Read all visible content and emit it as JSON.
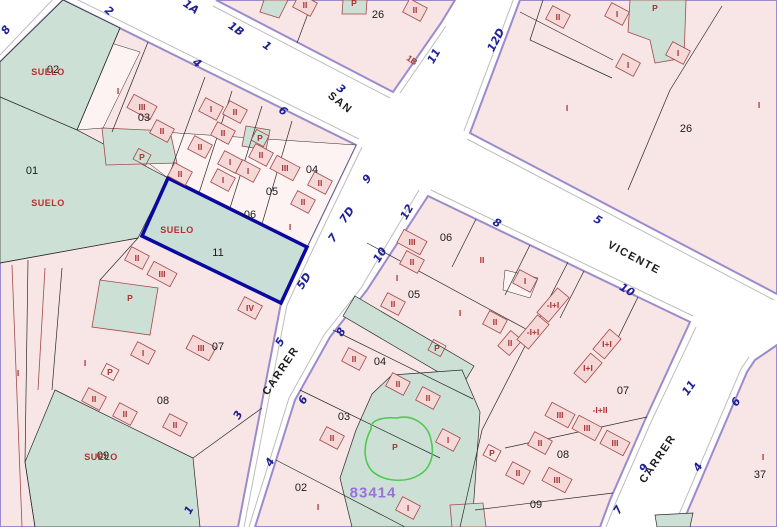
{
  "map": {
    "type": "cadastral parcel map",
    "selected_parcel": "11",
    "reference": "83414",
    "colors": {
      "block_fill": "#f8e5e5",
      "light_parcel_fill": "#fdf3f3",
      "green_fill": "#cde0d5",
      "block_border": "#9a8ccc",
      "parcel_line": "#2a2a2a",
      "building_line": "#a34a4a",
      "building_fill": "#f5d8d8",
      "street_number_color": "#1f1f96",
      "street_name_color": "#1c1c1c",
      "label_red": "#ab3232",
      "suelo_red": "#b53030",
      "selected_border": "#0909a0",
      "reference_purple": "#9a70dc",
      "highlight_green": "#4fc94f",
      "street_casing": "#bdbdbd"
    },
    "labels": {
      "street_names": [
        [
          "SAN",
          340,
          103,
          38
        ],
        [
          "VICENTE",
          634,
          258,
          28
        ],
        [
          "CARRER",
          281,
          371,
          -56
        ],
        [
          "CARRER",
          658,
          459,
          -56
        ]
      ],
      "street_numbers": [
        [
          "8",
          6,
          30,
          -55
        ],
        [
          "2",
          109,
          11,
          40
        ],
        [
          "1A",
          191,
          7,
          35
        ],
        [
          "1B",
          236,
          29,
          35
        ],
        [
          "1",
          267,
          46,
          35
        ],
        [
          "4",
          197,
          63,
          38
        ],
        [
          "3",
          341,
          89,
          38
        ],
        [
          "6",
          283,
          111,
          38
        ],
        [
          "11",
          434,
          56,
          -60
        ],
        [
          "12D",
          496,
          40,
          -62
        ],
        [
          "9",
          367,
          179,
          -50
        ],
        [
          "7D",
          347,
          215,
          -55
        ],
        [
          "7",
          333,
          238,
          -55
        ],
        [
          "5D",
          304,
          281,
          -58
        ],
        [
          "5",
          280,
          342,
          -58
        ],
        [
          "3",
          238,
          415,
          -60
        ],
        [
          "1",
          189,
          510,
          -62
        ],
        [
          "12",
          407,
          212,
          -60
        ],
        [
          "10",
          380,
          255,
          -58
        ],
        [
          "8",
          341,
          332,
          -58
        ],
        [
          "6",
          303,
          400,
          -58
        ],
        [
          "4",
          270,
          462,
          -60
        ],
        [
          "8",
          497,
          223,
          30
        ],
        [
          "5",
          598,
          220,
          30
        ],
        [
          "10",
          627,
          290,
          30
        ],
        [
          "11",
          689,
          388,
          -55
        ],
        [
          "9",
          644,
          468,
          -58
        ],
        [
          "7",
          618,
          510,
          -58
        ],
        [
          "6",
          736,
          402,
          -55
        ],
        [
          "4",
          698,
          467,
          -58
        ]
      ],
      "parcel_numbers": [
        [
          "02",
          53,
          70
        ],
        [
          "01",
          32,
          171
        ],
        [
          "03",
          144,
          118
        ],
        [
          "04",
          312,
          170
        ],
        [
          "05",
          272,
          192
        ],
        [
          "06",
          250,
          215
        ],
        [
          "11",
          218,
          253
        ],
        [
          "07",
          218,
          347
        ],
        [
          "08",
          163,
          401
        ],
        [
          "09",
          103,
          456
        ],
        [
          "26",
          378,
          15
        ],
        [
          "26",
          686,
          129
        ],
        [
          "06",
          446,
          238
        ],
        [
          "05",
          414,
          295
        ],
        [
          "04",
          380,
          362
        ],
        [
          "03",
          344,
          417
        ],
        [
          "02",
          301,
          488
        ],
        [
          "07",
          623,
          391
        ],
        [
          "08",
          563,
          455
        ],
        [
          "09",
          536,
          505
        ],
        [
          "37",
          760,
          475
        ]
      ],
      "suelo_labels": [
        [
          "SUELO",
          48,
          72
        ],
        [
          "SUELO",
          48,
          203
        ],
        [
          "SUELO",
          177,
          230
        ],
        [
          "SUELO",
          101,
          457
        ]
      ],
      "building_labels": [
        [
          "I",
          118,
          91,
          28,
          1
        ],
        [
          "III",
          142,
          107
        ],
        [
          "II",
          162,
          131
        ],
        [
          "P",
          142,
          157
        ],
        [
          "II",
          200,
          147
        ],
        [
          "II",
          180,
          174
        ],
        [
          "I",
          211,
          109
        ],
        [
          "II",
          235,
          112
        ],
        [
          "II",
          223,
          133
        ],
        [
          "P",
          260,
          138
        ],
        [
          "II",
          261,
          155
        ],
        [
          "I",
          230,
          162
        ],
        [
          "I",
          248,
          171
        ],
        [
          "I",
          223,
          180
        ],
        [
          "III",
          285,
          168
        ],
        [
          "II",
          320,
          183
        ],
        [
          "II",
          303,
          202
        ],
        [
          "I",
          290,
          227,
          28,
          1
        ],
        [
          "II",
          137,
          258
        ],
        [
          "III",
          162,
          274
        ],
        [
          "P",
          130,
          298,
          28,
          1
        ],
        [
          "IV",
          250,
          308
        ],
        [
          "I",
          85,
          363,
          28,
          1
        ],
        [
          "I",
          143,
          353
        ],
        [
          "P",
          110,
          372
        ],
        [
          "III",
          201,
          348
        ],
        [
          "II",
          94,
          399
        ],
        [
          "II",
          125,
          414
        ],
        [
          "II",
          175,
          425
        ],
        [
          "I",
          18,
          373,
          0,
          1
        ],
        [
          "II",
          305,
          5
        ],
        [
          "P",
          354,
          3,
          28,
          1
        ],
        [
          "II",
          415,
          10
        ],
        [
          "II",
          558,
          17
        ],
        [
          "I",
          617,
          14
        ],
        [
          "P",
          655,
          8,
          28,
          1
        ],
        [
          "I",
          678,
          53
        ],
        [
          "I",
          628,
          65
        ],
        [
          "I",
          567,
          108,
          0,
          1
        ],
        [
          "I",
          759,
          105,
          0,
          1
        ],
        [
          "III",
          412,
          242
        ],
        [
          "II",
          412,
          262
        ],
        [
          "II",
          482,
          260,
          28,
          1
        ],
        [
          "I",
          397,
          278,
          28,
          1
        ],
        [
          "II",
          393,
          304
        ],
        [
          "I",
          460,
          313,
          28,
          1
        ],
        [
          "II",
          495,
          322
        ],
        [
          "I",
          525,
          281
        ],
        [
          "II",
          354,
          359
        ],
        [
          "II",
          398,
          384
        ],
        [
          "II",
          428,
          398
        ],
        [
          "II",
          332,
          438
        ],
        [
          "I",
          318,
          507,
          28,
          1
        ],
        [
          "I",
          408,
          508
        ],
        [
          "P",
          437,
          348
        ],
        [
          "P",
          395,
          447,
          0,
          1
        ],
        [
          "I",
          448,
          440
        ],
        [
          "II",
          510,
          343,
          -50
        ],
        [
          "-I+I",
          553,
          305,
          -50
        ],
        [
          "-I+I",
          533,
          332,
          -50
        ],
        [
          "I+I",
          607,
          344,
          -50
        ],
        [
          "I+I",
          588,
          368,
          -50
        ],
        [
          "-I+II",
          600,
          410,
          28,
          1
        ],
        [
          "III",
          560,
          415
        ],
        [
          "III",
          587,
          428
        ],
        [
          "III",
          615,
          443
        ],
        [
          "P",
          492,
          453
        ],
        [
          "II",
          540,
          443
        ],
        [
          "III",
          557,
          480
        ],
        [
          "II",
          518,
          473
        ],
        [
          "I",
          763,
          457,
          0,
          1
        ]
      ],
      "facade_numbers": [
        [
          "1B",
          412,
          60,
          35
        ]
      ],
      "parcel_ref": [
        [
          "83414",
          373,
          493,
          0
        ]
      ]
    }
  }
}
